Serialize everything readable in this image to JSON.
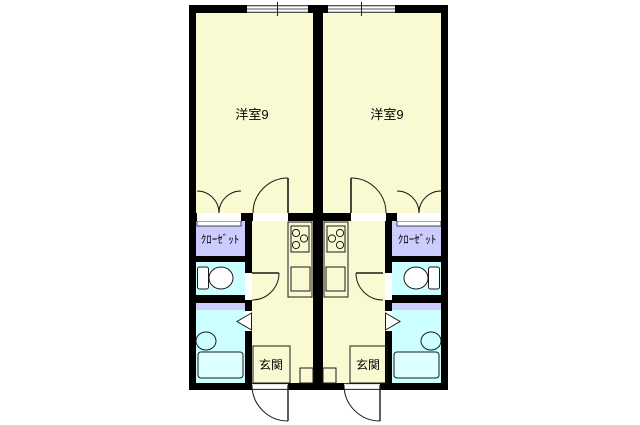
{
  "colors": {
    "bg": "#FFFFFF",
    "floor": "#FAFAD2",
    "closet": "#CCCCFF",
    "wet": "#CCFFFF",
    "tub": "#DCFFFF",
    "wall": "#000000",
    "line": "#1A1A1A",
    "fixture": "#FFFFFF"
  },
  "units": {
    "left": {
      "room_label": "洋室9",
      "closet_label": "ｸﾛｰｾﾞｯﾄ",
      "entrance_label": "玄関"
    },
    "right": {
      "room_label": "洋室9",
      "closet_label": "ｸﾛｰｾﾞｯﾄ",
      "entrance_label": "玄関"
    }
  }
}
